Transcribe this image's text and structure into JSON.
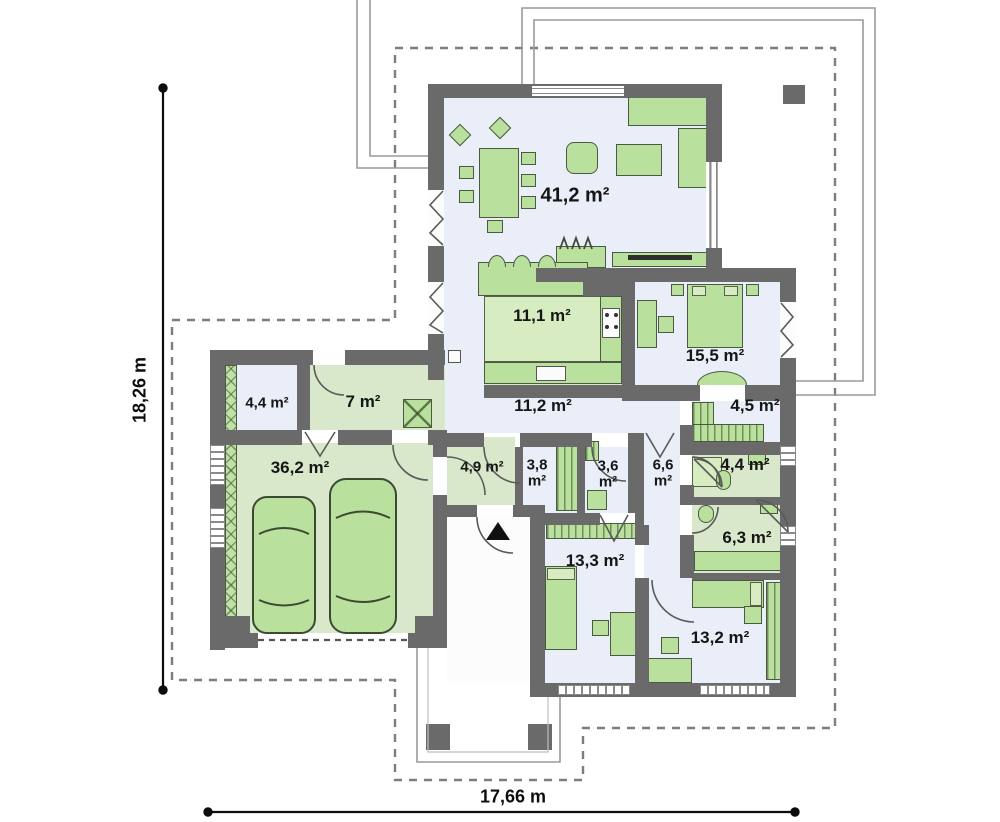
{
  "title": "Single-storey house floor plan",
  "dimensions": {
    "width": "17,66 m",
    "height": "18,26 m"
  },
  "rooms": {
    "living_room": {
      "area": "41,2 m²"
    },
    "kitchen": {
      "area": "11,1 m²"
    },
    "hall": {
      "area": "11,2 m²"
    },
    "master_bedroom": {
      "area": "15,5 m²"
    },
    "wardrobe": {
      "area": "4,5 m²"
    },
    "bathroom_small": {
      "area": "4,4 m²"
    },
    "bathroom": {
      "area": "6,3 m²"
    },
    "corridor": {
      "value": "6,6",
      "unit": "m²"
    },
    "wc": {
      "value": "3,6",
      "unit": "m²"
    },
    "pantry": {
      "value": "3,8",
      "unit": "m²"
    },
    "vestibule": {
      "area": "4,9 m²"
    },
    "garage": {
      "area": "36,2 m²"
    },
    "storage": {
      "area": "4,4 m²"
    },
    "utility_room": {
      "area": "7 m²"
    },
    "bedroom_2": {
      "area": "13,3 m²"
    },
    "bedroom_3": {
      "area": "13,2 m²"
    }
  },
  "colors": {
    "wall": "#6a6a6a",
    "floor_light": "#eaeef8",
    "floor_green": "#d9e7ca",
    "furniture": "#b9e09d",
    "furniture_outline": "#4a5940"
  }
}
